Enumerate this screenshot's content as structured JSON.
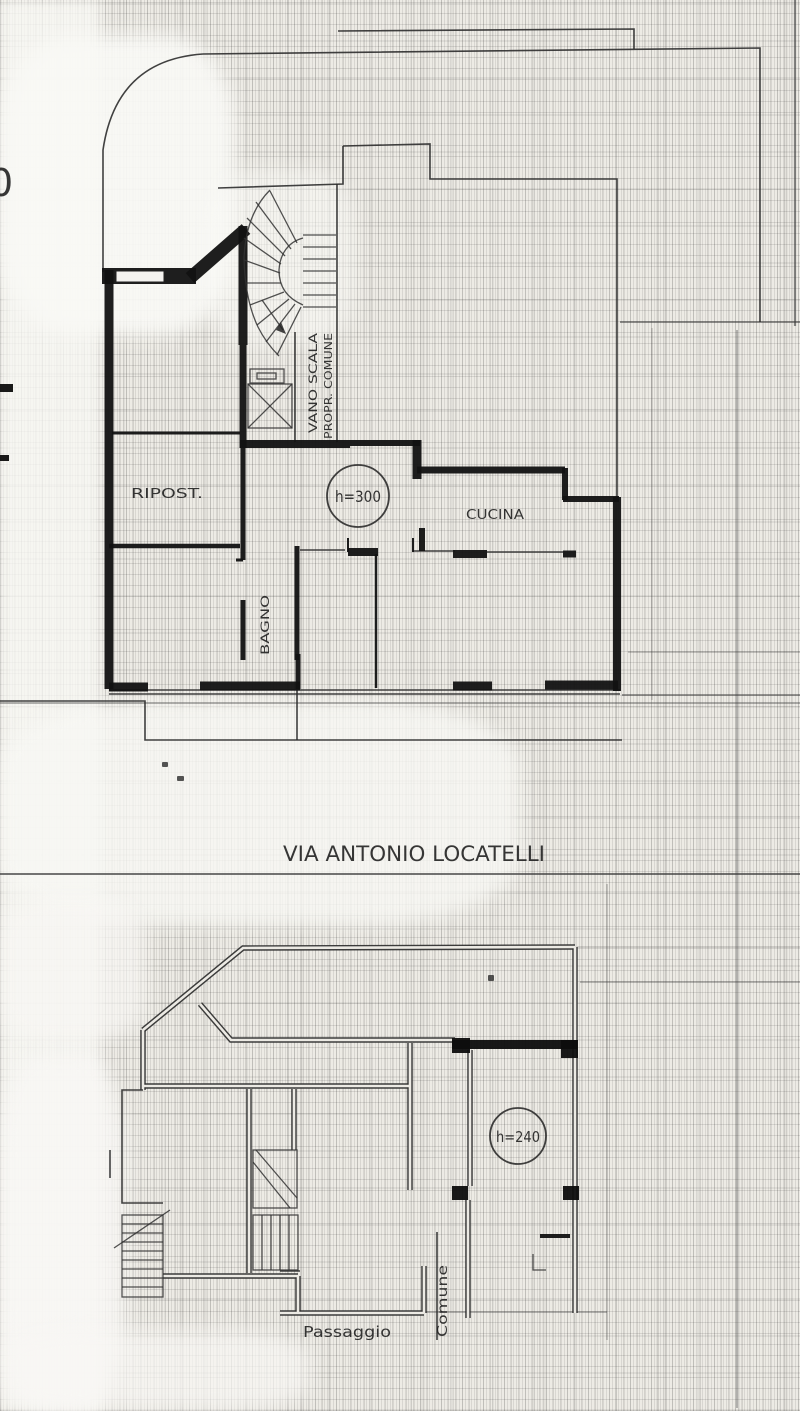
{
  "colors": {
    "paper": "#edebe5",
    "ink": "#121212",
    "line": "#2c2c2c"
  },
  "upper_plan": {
    "stairwell_label_line1": "VANO SCALA",
    "stairwell_label_line2": "PROPR. COMUNE",
    "room_ripost": "RIPOST.",
    "room_cucina": "CUCINA",
    "room_bagno": "BAGNO",
    "ceiling_height": "h=300"
  },
  "street_label": "VIA ANTONIO LOCATELLI",
  "lower_plan": {
    "ceiling_height": "h=240",
    "passage_label": "Passaggio",
    "shared_label": "Comune"
  },
  "margin_mark": "0"
}
